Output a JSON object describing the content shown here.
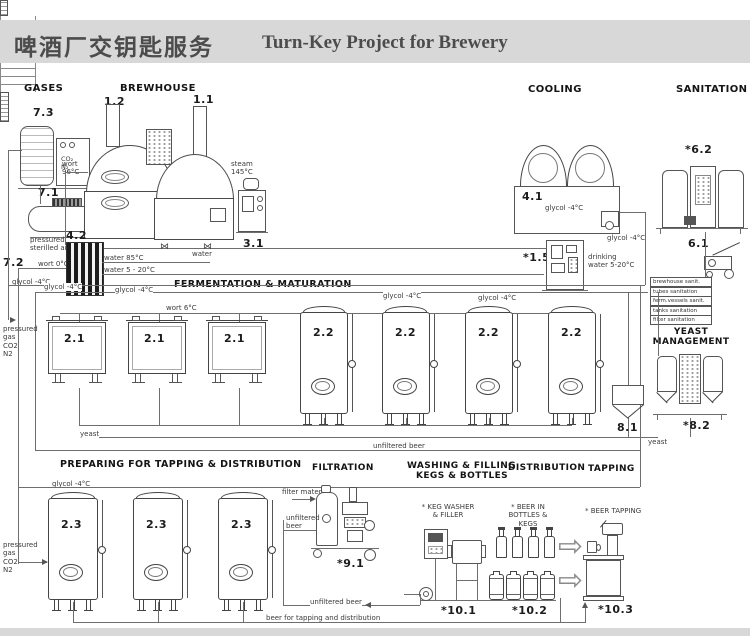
{
  "title": {
    "zh": "啤酒厂交钥匙服务",
    "en": "Turn-Key Project for Brewery"
  },
  "sections": {
    "gases": "GASES",
    "brewhouse": "BREWHOUSE",
    "cooling": "COOLING",
    "sanitation": "SANITATION",
    "fermentation": "FERMENTATION & MATURATION",
    "yeast_management": "YEAST\nMANAGEMENT",
    "preparing": "PREPARING FOR TAPPING & DISTRIBUTION",
    "filtration": "FILTRATION",
    "washing_line1": "WASHING & FILLING",
    "washing_line2": "KEGS & BOTTLES",
    "distribution": "DISTRIBUTION",
    "tapping": "TAPPING"
  },
  "tags": {
    "gas_tank": "7.3",
    "air_compressor": "7.1",
    "sterile_filter": "7.2",
    "mash_tun": "1.2",
    "brew_kettle": "1.1",
    "steam_generator": "3.1",
    "wort_cooler": "4.2",
    "glycol_unit": "4.1",
    "water_treatment": "*1.5",
    "cip_station": "*6.2",
    "cip_trolley": "6.1",
    "open_fermenter": "2.1",
    "ccv_tank": "2.2",
    "yeast_tank": "8.1",
    "yeast_management": "*8.2",
    "bright_tank": "2.3",
    "beer_filter": "*9.1",
    "keg_washer": "*10.1",
    "packaged_beer": "*10.2",
    "beer_tapping": "*10.3"
  },
  "labels": {
    "wort96": "wort\n96°C",
    "wort0": "wort 0°C",
    "wort6": "wort 6°C",
    "steam": "steam\n145°C",
    "air": "pressured\nsterilled air",
    "glycol": "glycol -4°C",
    "water85": "water 85°C",
    "water520": "water 5 - 20°C",
    "water": "water",
    "drinking": "drinking\nwater 5-20°C",
    "co2n2": "CO₂\nN₂",
    "pressured_gas": "pressured\ngas\nCO2\nN2",
    "yeast": "yeast",
    "unfiltered": "unfiltered beer",
    "unfiltered_2l": "unfiltered\nbeer",
    "filter_material": "filter material",
    "beer_dist": "beer for tapping and distribution",
    "keg_washer": "* KEG WASHER\n& FILLER",
    "beer_in": "* BEER IN\nBOTTLES & KEGS",
    "beer_tap": "* BEER TAPPING"
  },
  "sanitation_list": [
    "brewhouse sanit.",
    "tubes sanitation",
    "ferm.vessels sanit.",
    "tanks sanitation",
    "filter sanitation"
  ],
  "icons": {
    "distribution_arrow": "⇨",
    "valve": "⋈"
  },
  "colors": {
    "header_band": "#d8d8d8",
    "line": "#6e6e6e",
    "ink": "#1c1c1c",
    "label": "#3a3a3a",
    "title": "#4c4c4c"
  }
}
